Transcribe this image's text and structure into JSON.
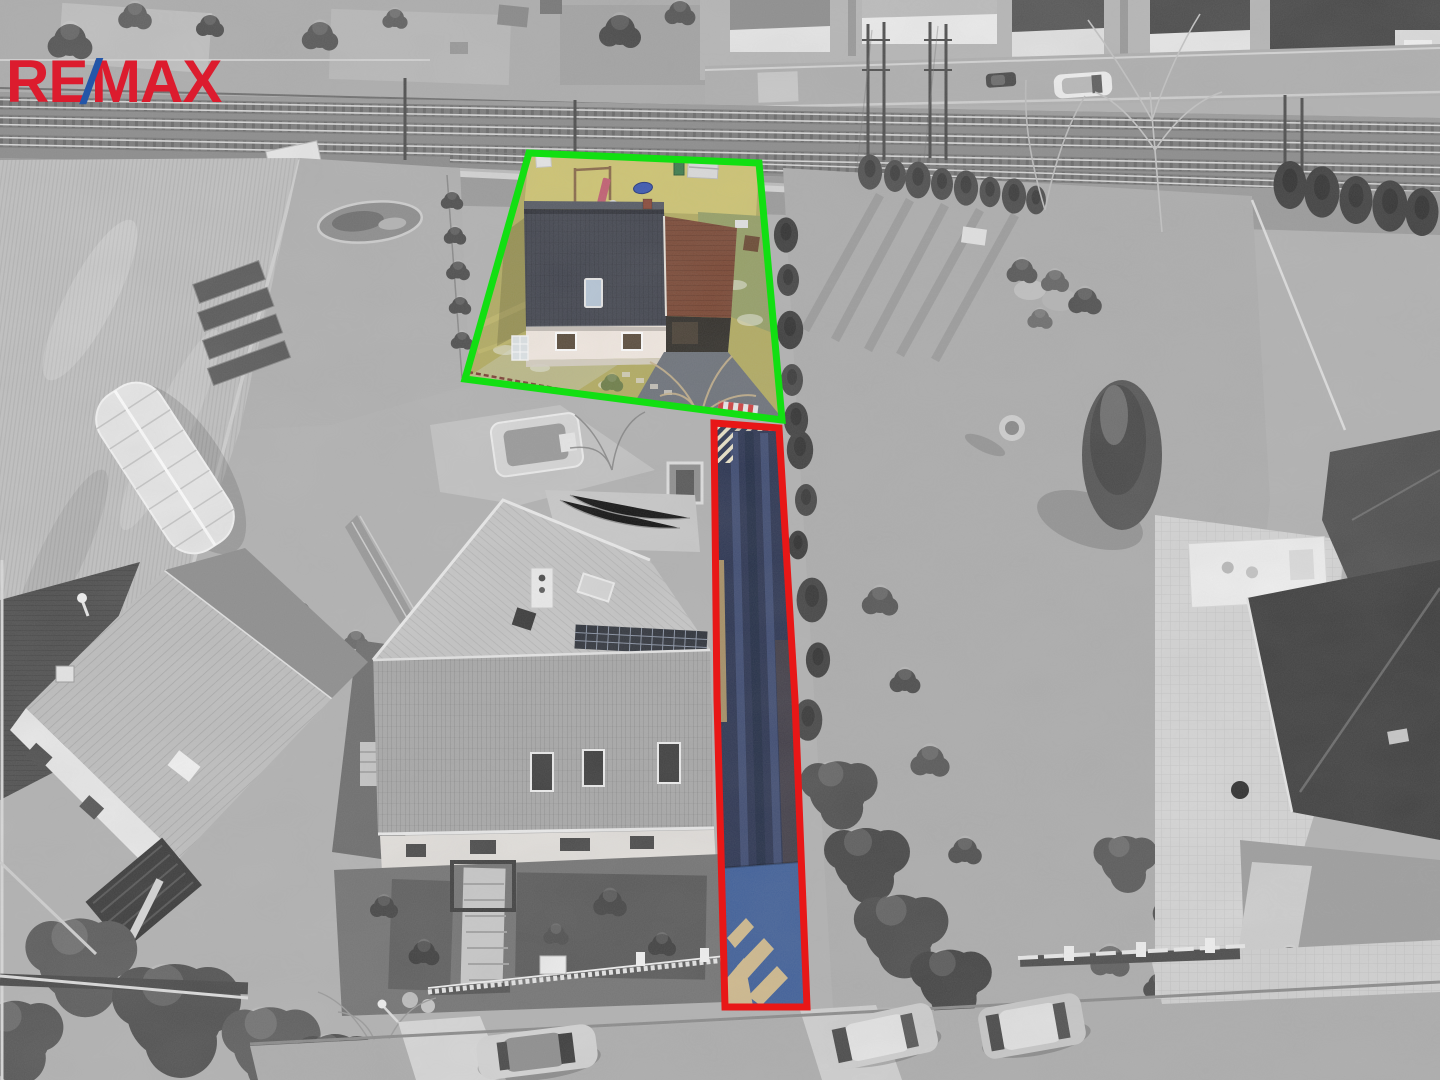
{
  "logo": {
    "re": "RE",
    "slash": "/",
    "max": "MAX"
  },
  "colors": {
    "logo_red": "#dc1c2e",
    "logo_blue": "#2456a8",
    "outline_green": "#12df12",
    "outline_red": "#e81717",
    "plot_grass": "#b3ac62",
    "plot_grass_sunlit": "#cfc573",
    "plot_grass_cool": "#96a067",
    "plot_house_roof": "#42454f",
    "plot_house_facade": "#f3eae2",
    "plot_barn_roof": "#7b4936",
    "plot_skylight": "#b7c7d8",
    "plot_driveway": "#6e737b",
    "access_road_asphalt": "#2c3552",
    "access_road_pavers": "#40609a",
    "access_road_paving_beige": "#d8bf8e",
    "barrier_stripe_red": "#cf4040",
    "slide_pink": "#c25f72",
    "trampoline_blue": "#3c58b0",
    "shed_green": "#3e7c4d"
  }
}
